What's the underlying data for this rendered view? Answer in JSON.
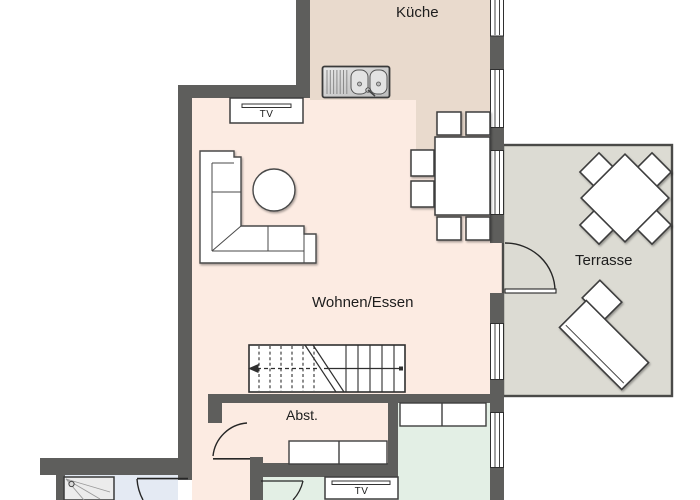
{
  "floorplan": {
    "type": "apartment-floor-plan",
    "labels": {
      "kitchen": "Küche",
      "living_dining": "Wohnen/Essen",
      "terrace": "Terrasse",
      "storage": "Abst.",
      "tv_living": "TV",
      "tv_lower_room": "TV"
    },
    "colors": {
      "wall": "#5e5e5c",
      "kitchen_floor": "#e9dacd",
      "living_floor": "#fcebe2",
      "green_room_floor": "#e3efe5",
      "bathroom_floor": "#e4eaf3",
      "terrace_floor": "#dcdbd3",
      "terrace_border": "#4a4a48",
      "furniture_line": "#3c3c3c",
      "background": "#ffffff"
    }
  }
}
